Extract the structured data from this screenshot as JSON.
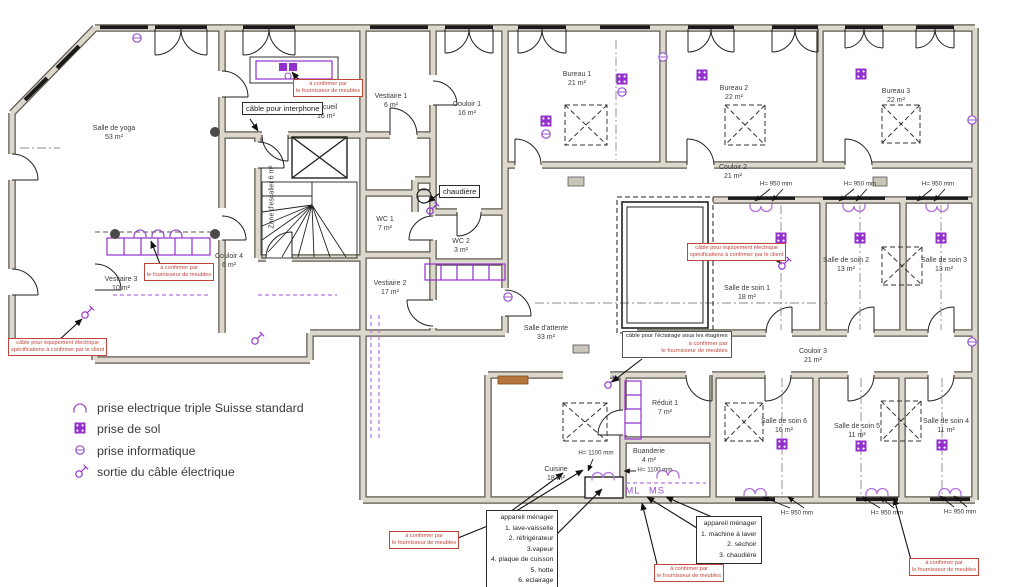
{
  "title": "floor plan with electrical annotations",
  "colors": {
    "purple": "#9330cc",
    "purple_light": "#b473de",
    "red": "#c0453a",
    "wall_edge": "#5d594f",
    "wall_fill": "#dcd8ce",
    "line": "#222222"
  },
  "rooms": {
    "yoga": {
      "name": "Salle de yoga",
      "area": "53 m²"
    },
    "vestiaire1": {
      "name": "Vestiaire 1",
      "area": "6 m²"
    },
    "accueil": {
      "name": "Accueil",
      "area": "16 m²"
    },
    "couloir1": {
      "name": "Couloir 1",
      "area": "16 m²"
    },
    "bureau1": {
      "name": "Bureau 1",
      "area": "21 m²"
    },
    "bureau2": {
      "name": "Bureau 2",
      "area": "22 m²"
    },
    "bureau3": {
      "name": "Bureau 3",
      "area": "22 m²"
    },
    "couloir2": {
      "name": "Couloir 2",
      "area": "21 m²"
    },
    "escalier": {
      "name": "Zone d'escalier",
      "area": "6 m²"
    },
    "wc1": {
      "name": "WC 1",
      "area": "7 m²"
    },
    "wc2": {
      "name": "WC 2",
      "area": "3 m²"
    },
    "vestiaire2": {
      "name": "Vestiaire 2",
      "area": "17 m²"
    },
    "vestiaire3": {
      "name": "Vestiaire 3",
      "area": "10 m²"
    },
    "couloir4": {
      "name": "Couloir 4",
      "area": "6 m²"
    },
    "soin1": {
      "name": "Salle de soin 1",
      "area": "18 m²"
    },
    "soin2": {
      "name": "Salle de soin 2",
      "area": "13 m²"
    },
    "soin3": {
      "name": "Salle de soin 3",
      "area": "13 m²"
    },
    "attente": {
      "name": "Salle d'attente",
      "area": "33 m²"
    },
    "couloir3": {
      "name": "Couloir 3",
      "area": "21 m²"
    },
    "reduit1": {
      "name": "Réduit 1",
      "area": "7 m²"
    },
    "buanderie": {
      "name": "Buanderie",
      "area": "4 m²"
    },
    "cuisine": {
      "name": "Cuisine",
      "area": "18 m²"
    },
    "soin6": {
      "name": "Salle de soin 6",
      "area": "16 m²"
    },
    "soin5": {
      "name": "Salle de soin 5",
      "area": "11 m²"
    },
    "soin4": {
      "name": "Salle de soin 4",
      "area": "11 m²"
    }
  },
  "callouts": {
    "interphone": "câble pour interphone",
    "chaudiere": "chaudière",
    "confirm": {
      "l1": "à confirmer par",
      "l2": "le fournisseur de meubles"
    },
    "cable_equip": {
      "l1": "câble pour équipement électrique",
      "l2": "spécifications à confirmer par le client"
    },
    "eclairage": {
      "l1": "câble pour l'éclairage sous les étagères",
      "l2": "à confirmer par",
      "l3": "le fournisseur de meubles"
    },
    "appareil_cuisine": {
      "title": "appareil ménager",
      "items": [
        "1. lave-vaisselle",
        "2. réfrigérateur",
        "3.vapeur",
        "4. plaque de cuisson",
        "5. hotte",
        "6. eclairage"
      ]
    },
    "appareil_buanderie": {
      "title": "appareil ménager",
      "items": [
        "1. machine à laver",
        "2. séchoir",
        "3. chaudière"
      ]
    }
  },
  "legend": {
    "items": [
      {
        "icon": "triple-socket-arc-icon",
        "label": "prise electrique triple Suisse standard"
      },
      {
        "icon": "floor-socket-icon",
        "label": "prise de sol"
      },
      {
        "icon": "network-socket-icon",
        "label": "prise informatique"
      },
      {
        "icon": "cable-exit-icon",
        "label": "sortie du câble électrique"
      }
    ]
  },
  "dimensions": {
    "h950": "H= 950 mm",
    "h1100": "H= 1100 mm"
  },
  "markers": {
    "ml": "ML",
    "ms": "MS"
  }
}
